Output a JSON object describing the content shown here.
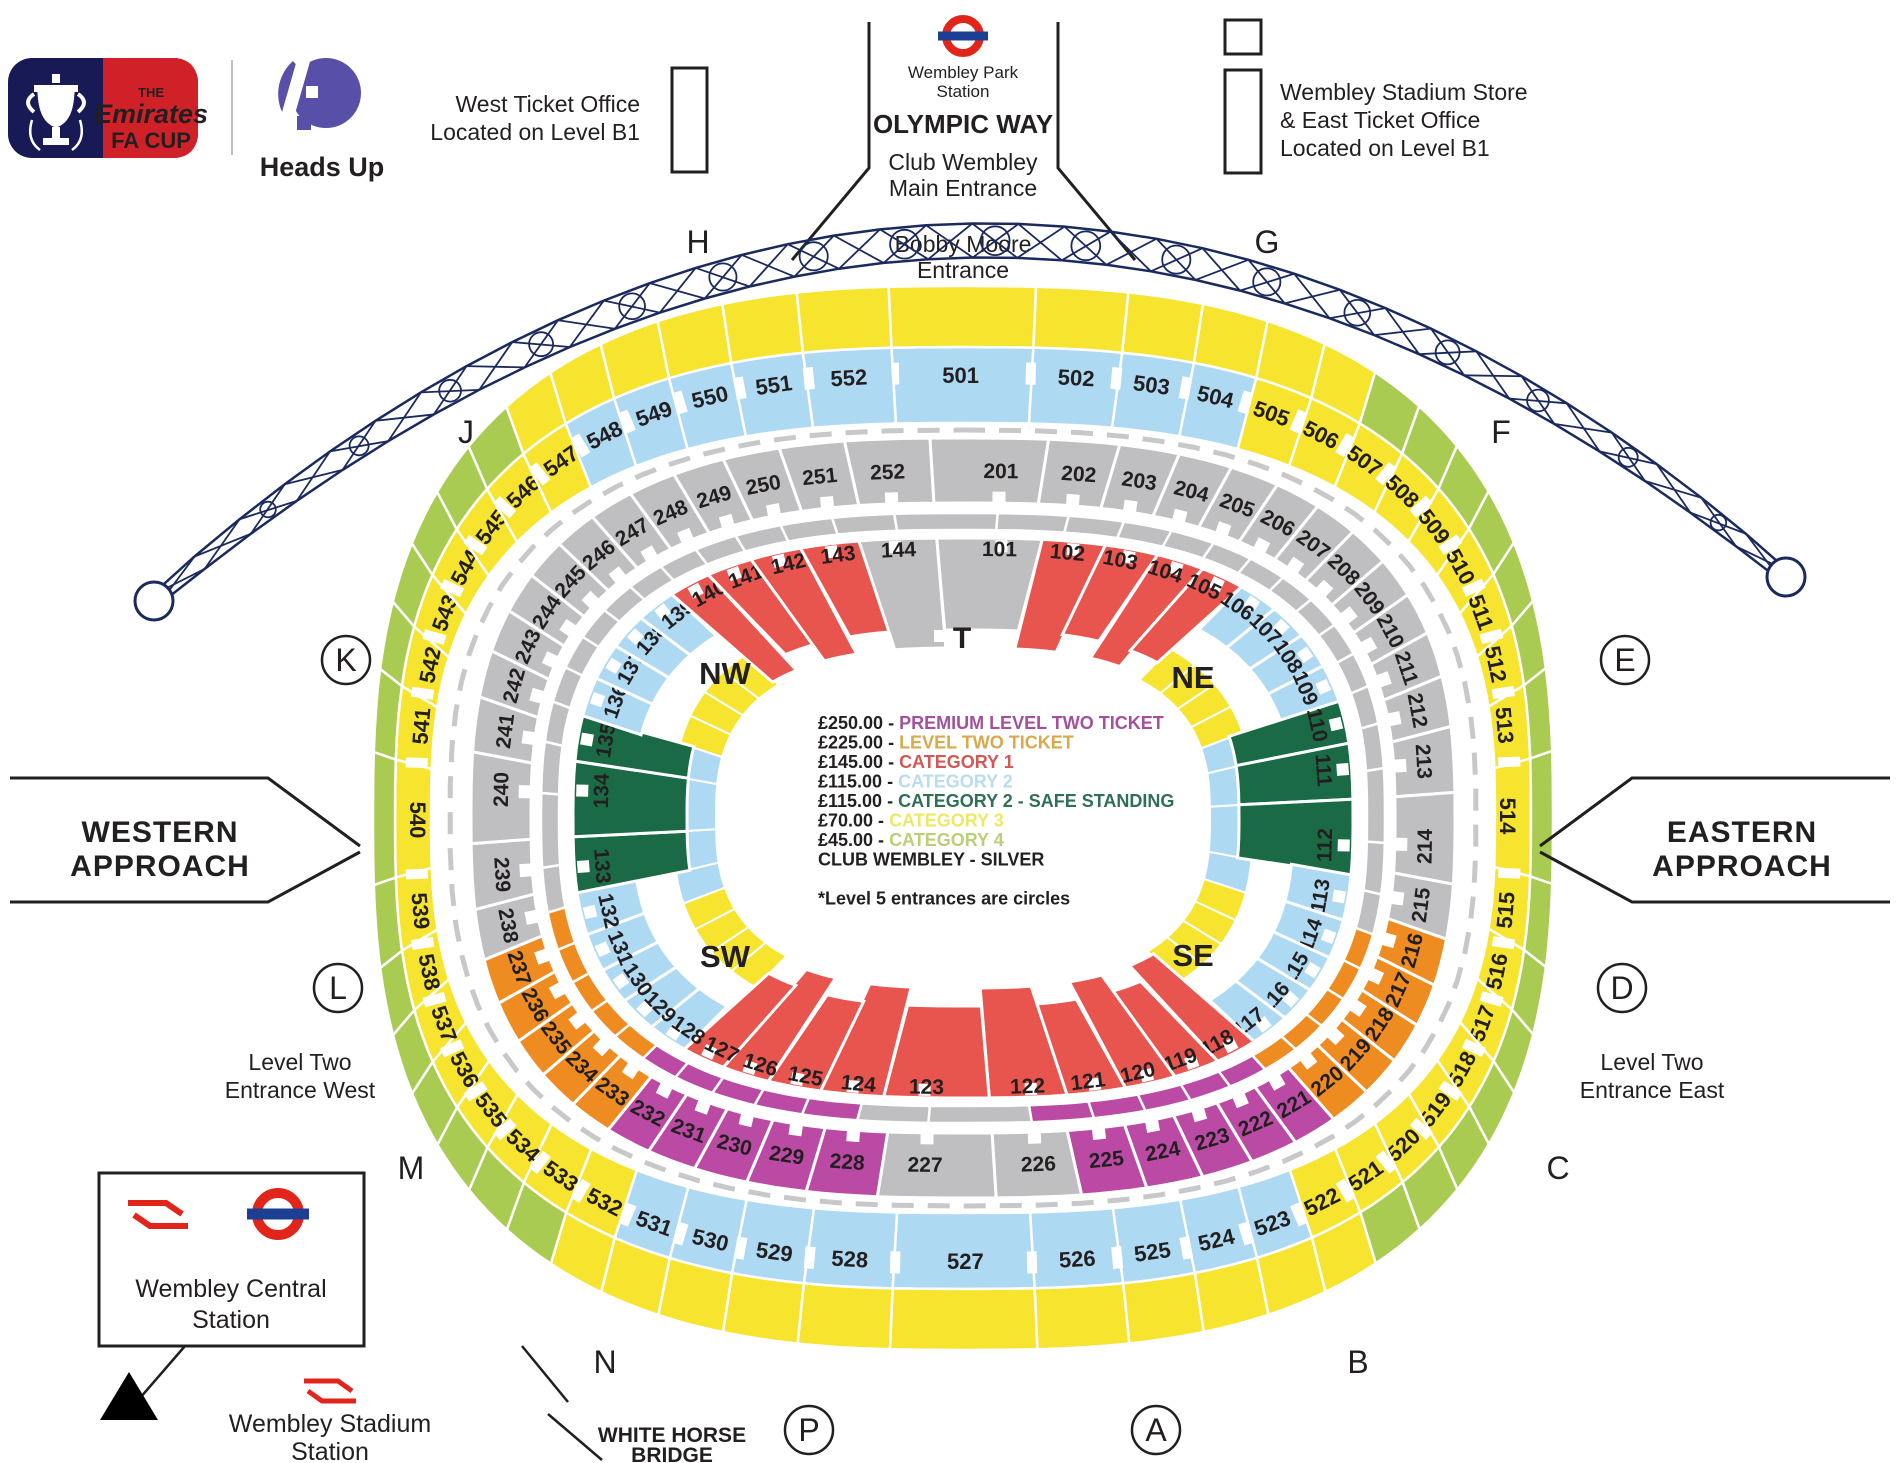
{
  "branding": {
    "fa_cup": {
      "the": "THE",
      "name": "Emirates",
      "cup": "FA CUP"
    },
    "heads_up": "Heads Up"
  },
  "top": {
    "wembley_park": [
      "Wembley Park",
      "Station"
    ],
    "olympic_way": "OLYMPIC  WAY",
    "club_wembley": [
      "Club Wembley",
      "Main Entrance"
    ],
    "bobby_moore": [
      "Bobby Moore",
      "Entrance"
    ],
    "west_ticket": [
      "West Ticket Office",
      "Located on Level B1"
    ],
    "store": [
      "Wembley Stadium Store",
      "& East Ticket Office",
      "Located on Level B1"
    ]
  },
  "legend": {
    "entries": [
      {
        "price": "£250.00",
        "label": "PREMIUM LEVEL TWO TICKET",
        "color": "#A4509C"
      },
      {
        "price": "£225.00",
        "label": "LEVEL TWO TICKET",
        "color": "#D9A94C"
      },
      {
        "price": "£145.00",
        "label": "CATEGORY 1",
        "color": "#D05955"
      },
      {
        "price": "£115.00",
        "label": "CATEGORY 2",
        "color": "#B9DCEE"
      },
      {
        "price": "£115.00",
        "label": "CATEGORY 2 - SAFE STANDING",
        "color": "#2F7054"
      },
      {
        "price": "£70.00",
        "label": "CATEGORY 3",
        "color": "#ECE968"
      },
      {
        "price": "£45.00",
        "label": "CATEGORY 4",
        "color": "#BACF77"
      }
    ],
    "club_line": "CLUB WEMBLEY - SILVER",
    "note": "*Level 5 entrances are circles"
  },
  "approaches": {
    "west": [
      "WESTERN",
      "APPROACH"
    ],
    "east": [
      "EASTERN",
      "APPROACH"
    ]
  },
  "entrances": {
    "west": [
      "Level Two",
      "Entrance West"
    ],
    "east": [
      "Level Two",
      "Entrance East"
    ]
  },
  "stations": {
    "central": [
      "Wembley Central",
      "Station"
    ],
    "stadium": [
      "Wembley Stadium",
      "Station"
    ]
  },
  "bridge": [
    "WHITE HORSE",
    "BRIDGE"
  ],
  "compass": {
    "nw": "NW",
    "ne": "NE",
    "sw": "SW",
    "se": "SE",
    "tunnel": "T"
  },
  "gates": [
    {
      "letter": "H",
      "circled": false
    },
    {
      "letter": "G",
      "circled": false
    },
    {
      "letter": "J",
      "circled": false
    },
    {
      "letter": "F",
      "circled": false
    },
    {
      "letter": "K",
      "circled": true
    },
    {
      "letter": "E",
      "circled": true
    },
    {
      "letter": "L",
      "circled": true
    },
    {
      "letter": "D",
      "circled": true
    },
    {
      "letter": "M",
      "circled": false
    },
    {
      "letter": "C",
      "circled": false
    },
    {
      "letter": "N",
      "circled": false
    },
    {
      "letter": "B",
      "circled": false
    },
    {
      "letter": "P",
      "circled": true
    },
    {
      "letter": "A",
      "circled": true
    }
  ],
  "colors": {
    "cat1": "#E8544E",
    "cat2": "#AED9F2",
    "cat3": "#F6E42F",
    "cat4": "#A9CB52",
    "safe": "#1A6B45",
    "silver": "#BFBFC1",
    "l2": "#EE8C22",
    "prem": "#BA4AA3",
    "arch": "#1B2A5E",
    "rail_red": "#E1251B",
    "tube_blue": "#1C3F94",
    "fa_navy": "#171A54",
    "fa_red": "#D02128",
    "heads_purple": "#584FA8",
    "heads_teal": "#29A9DF"
  },
  "stadium": {
    "level5": [
      {
        "from": 501,
        "to": 504,
        "outer": "cat3",
        "inner": "cat2"
      },
      {
        "from": 505,
        "to": 506,
        "outer": "cat3",
        "inner": "cat3"
      },
      {
        "from": 507,
        "to": 521,
        "outer": "cat4",
        "inner": "cat3"
      },
      {
        "from": 522,
        "to": 522,
        "outer": "cat3",
        "inner": "cat3"
      },
      {
        "from": 523,
        "to": 531,
        "outer": "cat3",
        "inner": "cat2"
      },
      {
        "from": 532,
        "to": 532,
        "outer": "cat3",
        "inner": "cat3"
      },
      {
        "from": 533,
        "to": 546,
        "outer": "cat4",
        "inner": "cat3"
      },
      {
        "from": 547,
        "to": 547,
        "outer": "cat3",
        "inner": "cat3"
      },
      {
        "from": 548,
        "to": 552,
        "outer": "cat3",
        "inner": "cat2"
      }
    ],
    "level2": [
      {
        "from": 201,
        "to": 215,
        "cat": "silver"
      },
      {
        "from": 216,
        "to": 220,
        "cat": "l2"
      },
      {
        "from": 221,
        "to": 225,
        "cat": "prem"
      },
      {
        "from": 226,
        "to": 227,
        "cat": "silver"
      },
      {
        "from": 228,
        "to": 232,
        "cat": "prem"
      },
      {
        "from": 233,
        "to": 237,
        "cat": "l2"
      },
      {
        "from": 238,
        "to": 252,
        "cat": "silver"
      }
    ],
    "level1": [
      {
        "from": 101,
        "to": 101,
        "cat": "silver",
        "depth": "full"
      },
      {
        "from": 102,
        "to": 105,
        "cat": "cat1",
        "depth": "full"
      },
      {
        "from": 106,
        "to": 109,
        "cat": "cat2",
        "depth": "std"
      },
      {
        "from": 110,
        "to": 112,
        "cat": "safe",
        "depth": "mid"
      },
      {
        "from": 113,
        "to": 117,
        "cat": "cat2",
        "depth": "std"
      },
      {
        "from": 118,
        "to": 127,
        "cat": "cat1",
        "depth": "full"
      },
      {
        "from": 128,
        "to": 132,
        "cat": "cat2",
        "depth": "std"
      },
      {
        "from": 133,
        "to": 135,
        "cat": "safe",
        "depth": "mid"
      },
      {
        "from": 136,
        "to": 139,
        "cat": "cat2",
        "depth": "std"
      },
      {
        "from": 140,
        "to": 143,
        "cat": "cat1",
        "depth": "full"
      },
      {
        "from": 144,
        "to": 144,
        "cat": "silver",
        "depth": "full"
      }
    ],
    "inner_strip": [
      {
        "from": 106,
        "to": 109,
        "cat": "cat3"
      },
      {
        "from": 110,
        "to": 113,
        "cat": "cat2"
      },
      {
        "from": 114,
        "to": 117,
        "cat": "cat3"
      },
      {
        "from": 128,
        "to": 131,
        "cat": "cat3"
      },
      {
        "from": 132,
        "to": 135,
        "cat": "cat2"
      },
      {
        "from": 136,
        "to": 139,
        "cat": "cat3"
      }
    ]
  }
}
